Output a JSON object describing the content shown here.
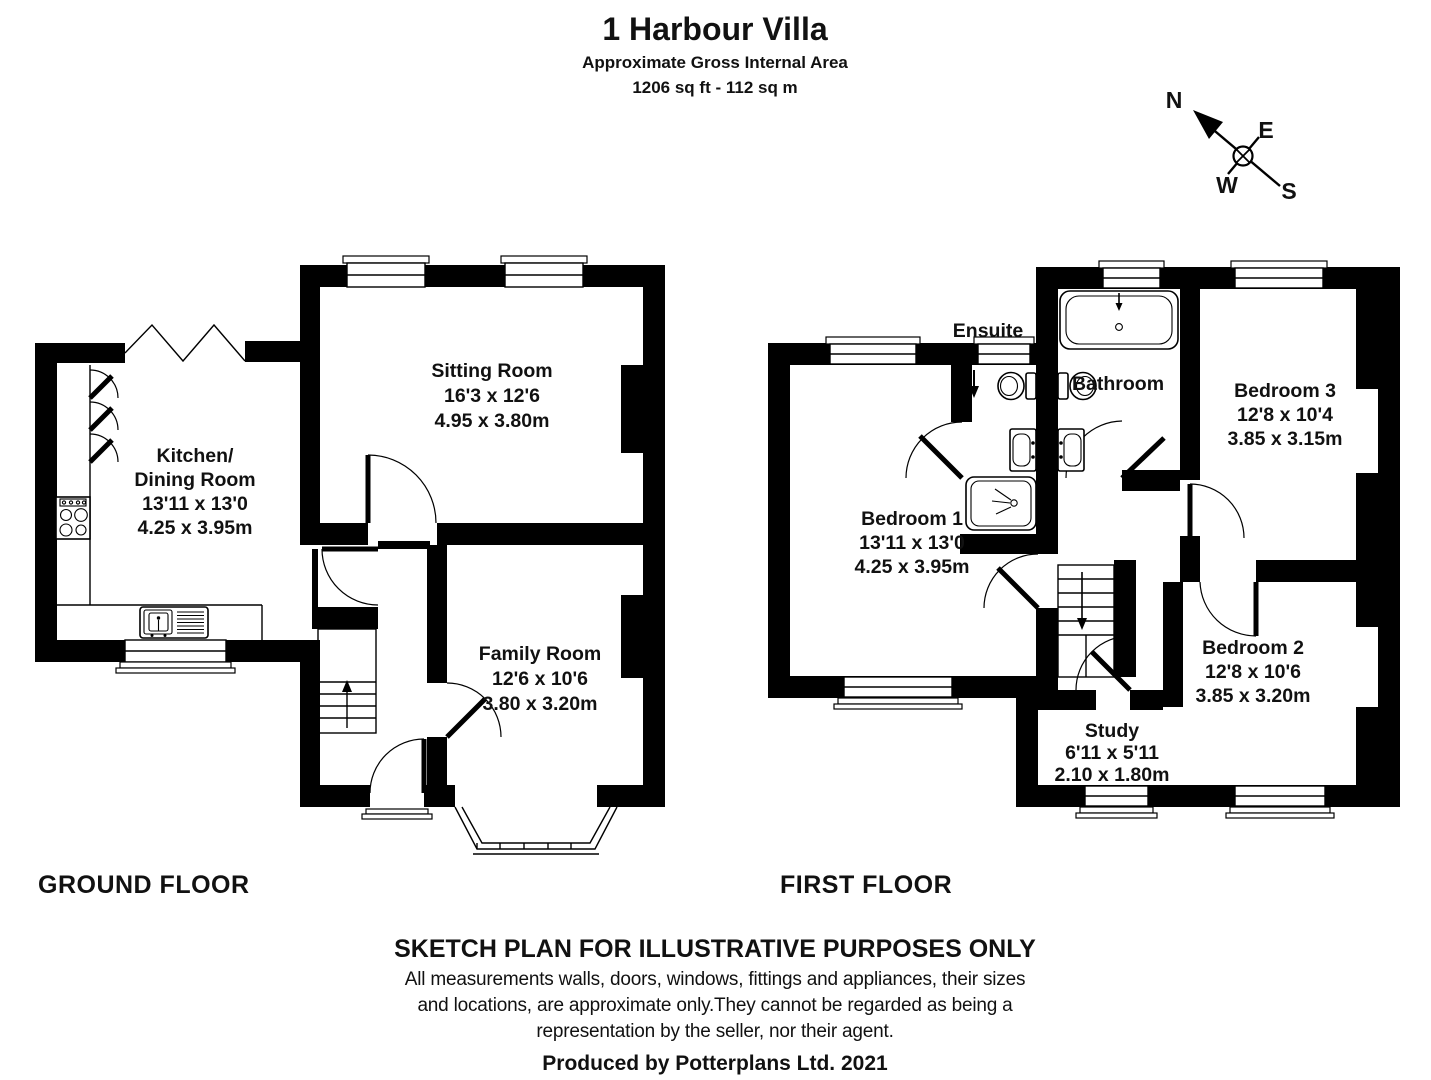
{
  "header": {
    "title": "1 Harbour Villa",
    "subtitle": "Approximate Gross Internal Area",
    "area": "1206 sq ft - 112 sq m"
  },
  "compass": {
    "north": "N",
    "east": "E",
    "south": "S",
    "west": "W"
  },
  "ground_floor": {
    "label": "GROUND FLOOR",
    "rooms": {
      "kitchen": {
        "name_line1": "Kitchen/",
        "name_line2": "Dining Room",
        "imperial": "13'11 x 13'0",
        "metric": "4.25 x 3.95m"
      },
      "sitting": {
        "name": "Sitting Room",
        "imperial": "16'3 x 12'6",
        "metric": "4.95 x 3.80m"
      },
      "family": {
        "name": "Family Room",
        "imperial": "12'6 x 10'6",
        "metric": "3.80 x 3.20m"
      }
    }
  },
  "first_floor": {
    "label": "FIRST FLOOR",
    "rooms": {
      "bedroom1": {
        "name": "Bedroom 1",
        "imperial": "13'11 x 13'0",
        "metric": "4.25 x 3.95m"
      },
      "bedroom2": {
        "name": "Bedroom 2",
        "imperial": "12'8 x 10'6",
        "metric": "3.85 x 3.20m"
      },
      "bedroom3": {
        "name": "Bedroom 3",
        "imperial": "12'8 x 10'4",
        "metric": "3.85 x 3.15m"
      },
      "study": {
        "name": "Study",
        "imperial": "6'11 x 5'11",
        "metric": "2.10 x 1.80m"
      },
      "bathroom": {
        "name": "Bathroom"
      },
      "ensuite": {
        "name": "Ensuite"
      }
    }
  },
  "footer": {
    "disclaimer_title": "SKETCH PLAN FOR ILLUSTRATIVE PURPOSES ONLY",
    "disclaimer_line1": "All measurements walls, doors, windows, fittings and appliances, their sizes",
    "disclaimer_line2": "and locations, are approximate only.They cannot be regarded as being a",
    "disclaimer_line3": "representation by the seller, nor their agent.",
    "credit": "Produced by Potterplans Ltd. 2021"
  },
  "colors": {
    "wall": "#000000",
    "background": "#ffffff",
    "text": "#111111"
  }
}
